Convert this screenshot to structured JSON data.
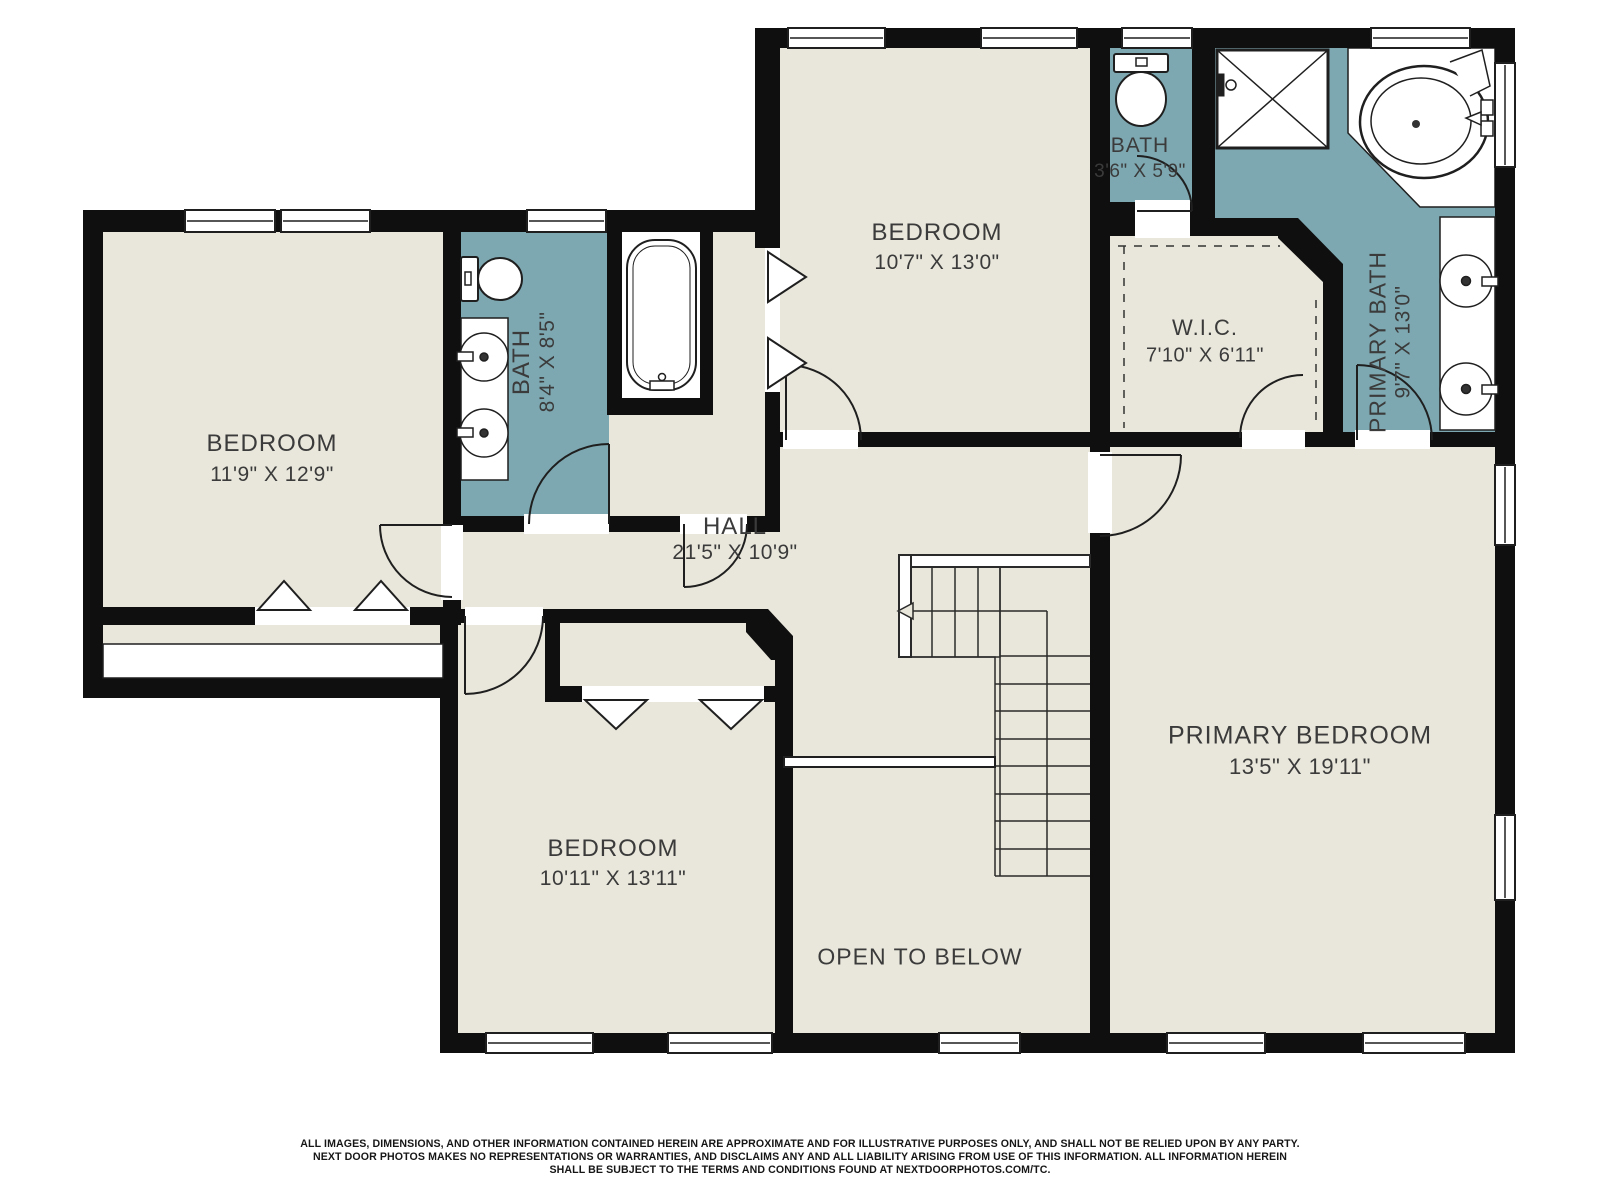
{
  "palette": {
    "floor": "#e9e7db",
    "wet_room_floor": "#7da8b1",
    "wall": "#0f0f0f",
    "line": "#1f1f1f",
    "label_text": "#3b3b3b"
  },
  "rooms": {
    "bedroom_left": {
      "name": "BEDROOM",
      "dims": "11'9\" X 12'9\""
    },
    "bath_left": {
      "name": "BATH",
      "dims": "8'4\" X 8'5\""
    },
    "bedroom_top": {
      "name": "BEDROOM",
      "dims": "10'7\" X 13'0\""
    },
    "bath_small": {
      "name": "BATH",
      "dims": "3'6\" X 5'9\""
    },
    "wic": {
      "name": "W.I.C.",
      "dims": "7'10\" X 6'11\""
    },
    "primary_bath": {
      "name": "PRIMARY BATH",
      "dims": "9'7\" X 13'0\""
    },
    "hall": {
      "name": "HALL",
      "dims": "21'5\" X 10'9\""
    },
    "bedroom_bottom": {
      "name": "BEDROOM",
      "dims": "10'11\" X 13'11\""
    },
    "primary_bedroom": {
      "name": "PRIMARY BEDROOM",
      "dims": "13'5\" X 19'11\""
    },
    "open_to_below": {
      "name": "OPEN TO BELOW"
    }
  },
  "disclaimer": {
    "line1": "ALL IMAGES, DIMENSIONS, AND OTHER INFORMATION CONTAINED HEREIN ARE APPROXIMATE AND FOR ILLUSTRATIVE PURPOSES ONLY, AND SHALL NOT BE RELIED UPON BY ANY PARTY.",
    "line2": "NEXT DOOR PHOTOS MAKES NO REPRESENTATIONS OR WARRANTIES, AND DISCLAIMS ANY AND ALL LIABILITY ARISING FROM USE OF THIS INFORMATION. ALL INFORMATION HEREIN",
    "line3": "SHALL BE SUBJECT TO THE TERMS AND CONDITIONS FOUND AT NEXTDOORPHOTOS.COM/TC."
  }
}
